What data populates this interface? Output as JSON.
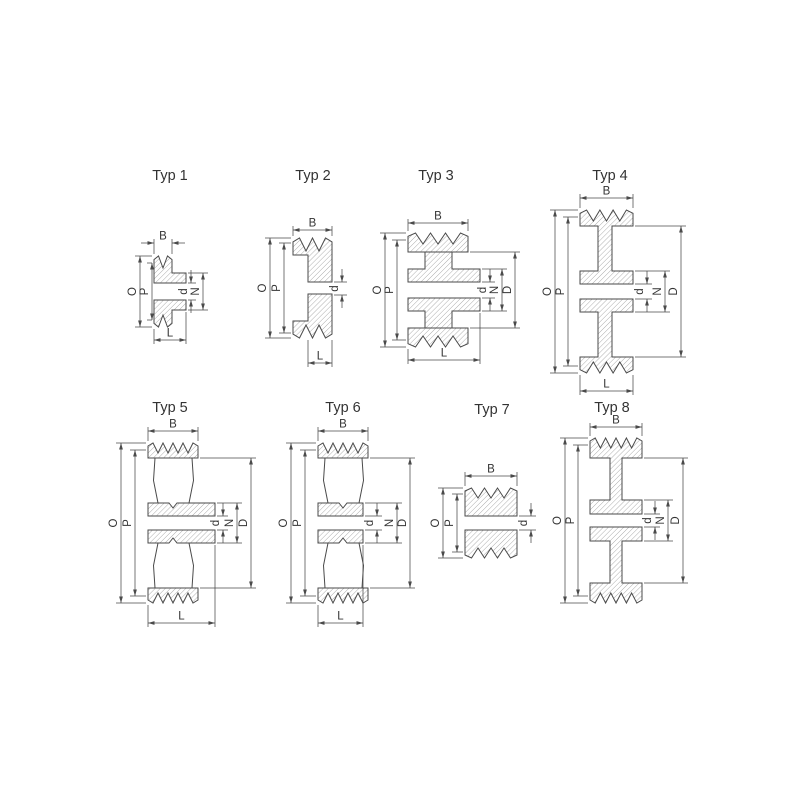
{
  "diagram": {
    "description": "V-belt pulley type cross-sections",
    "figures": [
      {
        "id": "typ1",
        "title": "Typ 1",
        "grooves": 1,
        "dimensions": [
          "B",
          "O",
          "P",
          "d",
          "N",
          "L"
        ]
      },
      {
        "id": "typ2",
        "title": "Typ 2",
        "grooves": 2,
        "dimensions": [
          "B",
          "O",
          "P",
          "d",
          "L"
        ]
      },
      {
        "id": "typ3",
        "title": "Typ 3",
        "grooves": 3,
        "dimensions": [
          "B",
          "O",
          "P",
          "d",
          "N",
          "D",
          "L"
        ]
      },
      {
        "id": "typ4",
        "title": "Typ 4",
        "grooves": 3,
        "dimensions": [
          "B",
          "O",
          "P",
          "d",
          "N",
          "D",
          "L"
        ]
      },
      {
        "id": "typ5",
        "title": "Typ 5",
        "grooves": 4,
        "dimensions": [
          "B",
          "O",
          "P",
          "d",
          "N",
          "D",
          "L"
        ]
      },
      {
        "id": "typ6",
        "title": "Typ 6",
        "grooves": 4,
        "dimensions": [
          "B",
          "O",
          "P",
          "d",
          "N",
          "D",
          "L"
        ]
      },
      {
        "id": "typ7",
        "title": "Typ 7",
        "grooves": 3,
        "dimensions": [
          "B",
          "O",
          "P",
          "d"
        ]
      },
      {
        "id": "typ8",
        "title": "Typ 8",
        "grooves": 4,
        "dimensions": [
          "B",
          "O",
          "P",
          "d",
          "N",
          "D"
        ]
      }
    ]
  },
  "figures": [
    {
      "title": "Typ 1"
    },
    {
      "title": "Typ 2"
    },
    {
      "title": "Typ 3"
    },
    {
      "title": "Typ 4"
    },
    {
      "title": "Typ 5"
    },
    {
      "title": "Typ 6"
    },
    {
      "title": "Typ 7"
    },
    {
      "title": "Typ 8"
    }
  ],
  "dimension_labels": {
    "B": "B",
    "O": "O",
    "P": "P",
    "d": "d",
    "N": "N",
    "D": "D",
    "L": "L"
  },
  "colors": {
    "line": "#4a4a4a",
    "hatch": "#7a7a7a",
    "text": "#333333",
    "background": "#ffffff"
  }
}
